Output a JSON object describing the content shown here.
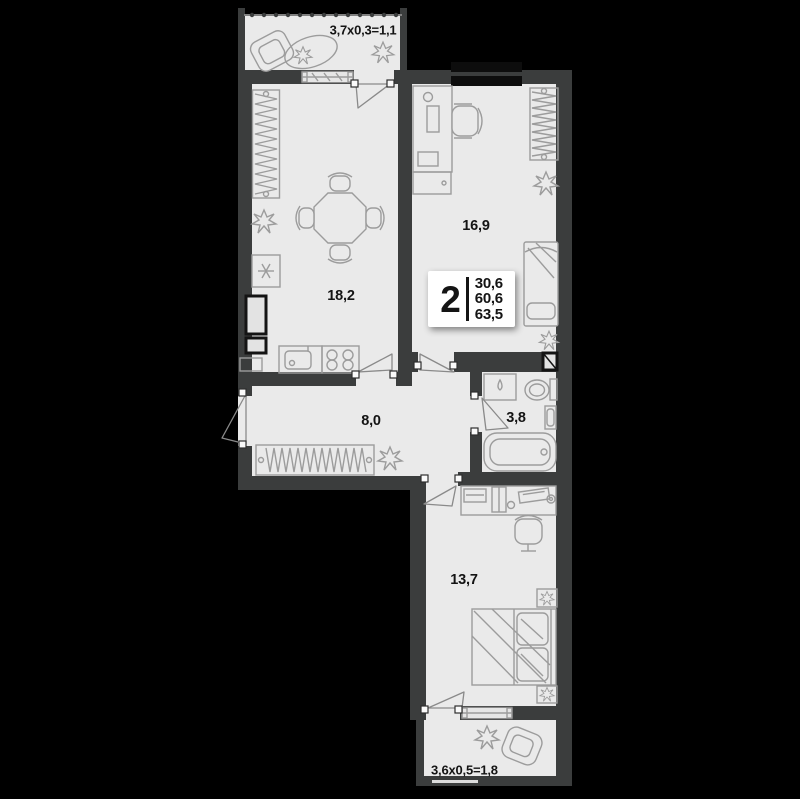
{
  "apartment": {
    "rooms_count": "2",
    "areas_stack": [
      "30,6",
      "60,6",
      "63,5"
    ]
  },
  "labels": {
    "balcony_top": "3,7x0,3=1,1",
    "room": "16,9",
    "kitchen_living": "18,2",
    "hallway": "8,0",
    "bathroom": "3,8",
    "bedroom": "13,7",
    "balcony_bottom": "3,6x0,5=1,8"
  },
  "colors": {
    "background": "#000000",
    "walls": "#3b3d3d",
    "floor": "#eaeaea",
    "furniture_stroke": "#9c9c9c",
    "text": "#141414",
    "info_box_bg": "#ffffff"
  }
}
